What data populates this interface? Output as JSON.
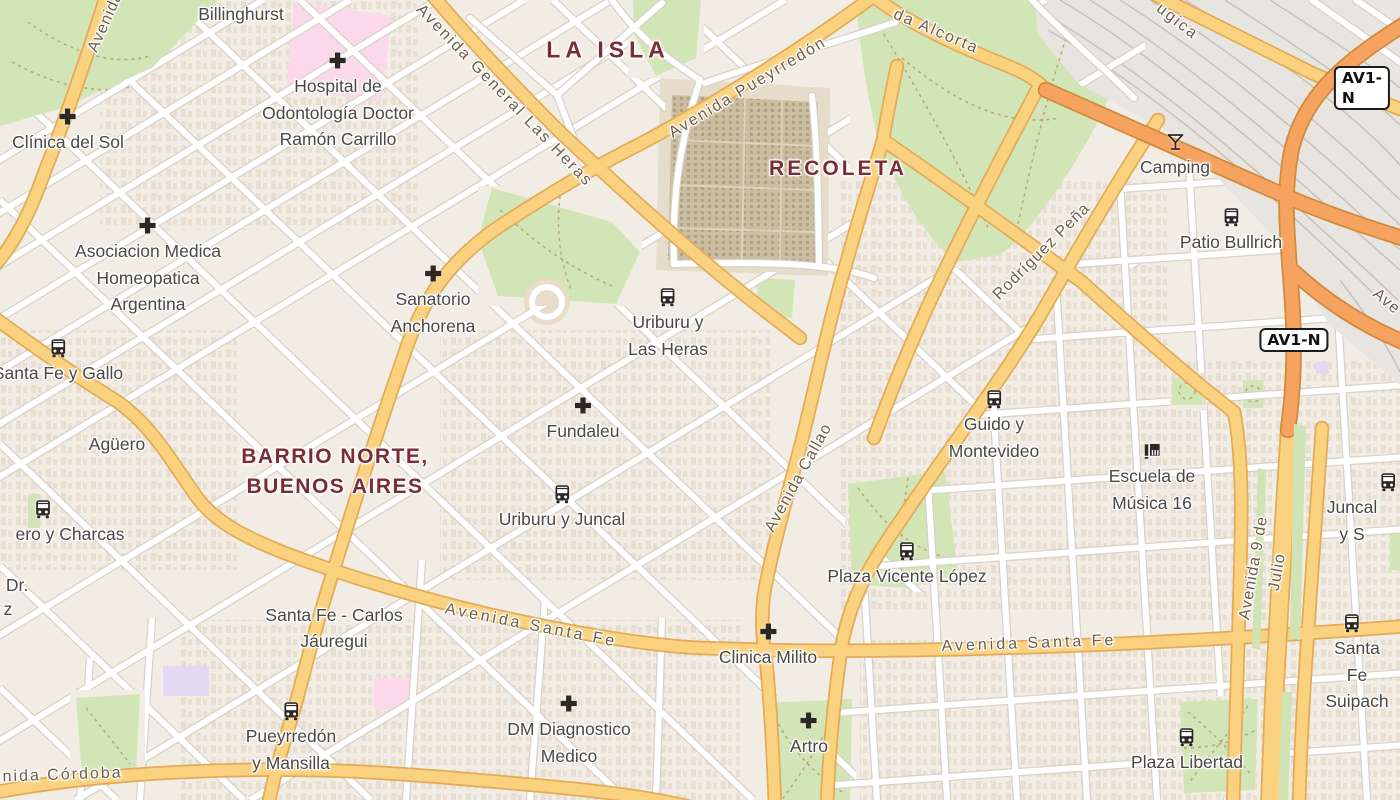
{
  "map_view": {
    "badges": [
      {
        "text": "AV1-N",
        "x": 1362,
        "y": 88
      },
      {
        "text": "AV1-N",
        "x": 1294,
        "y": 340
      }
    ],
    "area_labels": [
      {
        "text": "LA ISLA",
        "x": 608,
        "y": 50,
        "size": 23,
        "ls": 5
      },
      {
        "text": "RECOLETA",
        "x": 838,
        "y": 169,
        "size": 21,
        "ls": 3
      },
      {
        "text": "BARRIO NORTE,\nBUENOS AIRES",
        "x": 335,
        "y": 472,
        "size": 21,
        "ls": 1.5
      }
    ],
    "road_labels": [
      {
        "text": "Avenida",
        "x": 106,
        "y": 22,
        "angle": -66,
        "ls": 1
      },
      {
        "text": "Avenida General Las Heras",
        "x": 504,
        "y": 96,
        "angle": 46,
        "ls": 2
      },
      {
        "text": "Avenida Pueyrredón",
        "x": 748,
        "y": 88,
        "angle": -31,
        "ls": 2
      },
      {
        "text": "da Alcorta",
        "x": 936,
        "y": 32,
        "angle": 23,
        "ls": 2
      },
      {
        "text": "ugica",
        "x": 1177,
        "y": 22,
        "angle": 38,
        "ls": 2
      },
      {
        "text": "Rodríguez Peña",
        "x": 1042,
        "y": 252,
        "angle": -45,
        "ls": 1
      },
      {
        "text": "Avenida Callao",
        "x": 799,
        "y": 478,
        "angle": -61,
        "ls": 1
      },
      {
        "text": "Avenida Santa Fe",
        "x": 531,
        "y": 626,
        "angle": 11,
        "ls": 3
      },
      {
        "text": "Avenida Santa Fe",
        "x": 1029,
        "y": 644,
        "angle": -2,
        "ls": 3
      },
      {
        "text": "Avenida 9 de Julio",
        "x": 1266,
        "y": 570,
        "angle": -80,
        "ls": 1
      },
      {
        "text": "Avenida Córdoba",
        "x": 46,
        "y": 776,
        "angle": -2,
        "ls": 2
      },
      {
        "text": "Ave",
        "x": 1386,
        "y": 302,
        "angle": 40,
        "ls": 1
      }
    ],
    "street_labels": [
      {
        "text": "Billinghurst",
        "x": 241,
        "y": 14
      },
      {
        "text": "Agüero",
        "x": 117,
        "y": 444
      },
      {
        "text": "Santa Fe - Carlos\nJáuregui",
        "x": 334,
        "y": 628
      }
    ],
    "poi_labels": [
      {
        "icon": "hospital",
        "lines": [
          "Hospital de",
          "Odontología Doctor",
          "Ramón Carrillo"
        ],
        "x": 338,
        "y": 50
      },
      {
        "icon": "hospital",
        "lines": [
          "Clínica del Sol"
        ],
        "x": 68,
        "y": 106
      },
      {
        "icon": "hospital",
        "lines": [
          "Asociacion Medica",
          "Homeopatica",
          "Argentina"
        ],
        "x": 148,
        "y": 215
      },
      {
        "icon": "hospital",
        "lines": [
          "Sanatorio",
          "Anchorena"
        ],
        "x": 433,
        "y": 263
      },
      {
        "icon": "bus",
        "lines": [
          "Uriburu y",
          "Las Heras"
        ],
        "x": 668,
        "y": 286
      },
      {
        "icon": "hospital",
        "lines": [
          "Fundaleu"
        ],
        "x": 583,
        "y": 395
      },
      {
        "icon": "bus",
        "lines": [
          "Uriburu y Juncal"
        ],
        "x": 562,
        "y": 483
      },
      {
        "icon": "bus",
        "lines": [
          "Santa Fe y Gallo"
        ],
        "x": 58,
        "y": 337
      },
      {
        "icon": "bus",
        "lines": [
          "Guido y",
          "Montevideo"
        ],
        "x": 994,
        "y": 388
      },
      {
        "icon": "piano",
        "lines": [
          "Escuela de",
          "Música 16"
        ],
        "x": 1152,
        "y": 440
      },
      {
        "icon": "bus",
        "lines": [
          "Plaza Vicente López"
        ],
        "x": 907,
        "y": 540
      },
      {
        "icon": "bus",
        "lines": [
          "ero y Charcas"
        ],
        "x": 70,
        "y": 498,
        "icon_dx": -27
      },
      {
        "icon": "bar",
        "lines": [
          "Camping"
        ],
        "x": 1175,
        "y": 131
      },
      {
        "icon": "bus",
        "lines": [
          "Patio Bullrich"
        ],
        "x": 1231,
        "y": 206
      },
      {
        "icon": "bus",
        "lines": [
          "Juncal y S"
        ],
        "x": 1352,
        "y": 471,
        "icon_dx": 36
      },
      {
        "icon": "bus",
        "lines": [
          "Santa Fe",
          "Suipach"
        ],
        "x": 1357,
        "y": 612,
        "icon_dx": -5
      },
      {
        "icon": "hospital",
        "lines": [
          "Clinica Milito"
        ],
        "x": 768,
        "y": 621
      },
      {
        "icon": "hospital",
        "lines": [
          "DM Diagnostico",
          "Medico"
        ],
        "x": 569,
        "y": 693
      },
      {
        "icon": "hospital",
        "lines": [
          "Artro"
        ],
        "x": 809,
        "y": 710
      },
      {
        "icon": "bus",
        "lines": [
          "Pueyrredón",
          "y Mansilla"
        ],
        "x": 291,
        "y": 700
      },
      {
        "icon": "bus",
        "lines": [
          "Plaza Libertad"
        ],
        "x": 1187,
        "y": 726
      },
      {
        "icon": null,
        "lines": [
          "Dr."
        ],
        "x": 17,
        "y": 572
      },
      {
        "icon": null,
        "lines": [
          "z"
        ],
        "x": 8,
        "y": 596
      }
    ],
    "colors": {
      "land": "#f1ede4",
      "avenue": "#fad27f",
      "avenue_casing": "#e3ab58",
      "trunk": "#f5a35f",
      "trunk_casing": "#cf8a3b",
      "street": "#ffffff",
      "street_casing": "#d8d2c7",
      "park": "#d2e5b6",
      "cemetery": "#cbbda0",
      "hospital_zone": "#fbd9ea",
      "railyard": "#e8e4df",
      "label_area": "#7b2b33",
      "label_poi": "#4a4845",
      "label_road": "#6e5e46",
      "icon": "#2c2925"
    }
  }
}
